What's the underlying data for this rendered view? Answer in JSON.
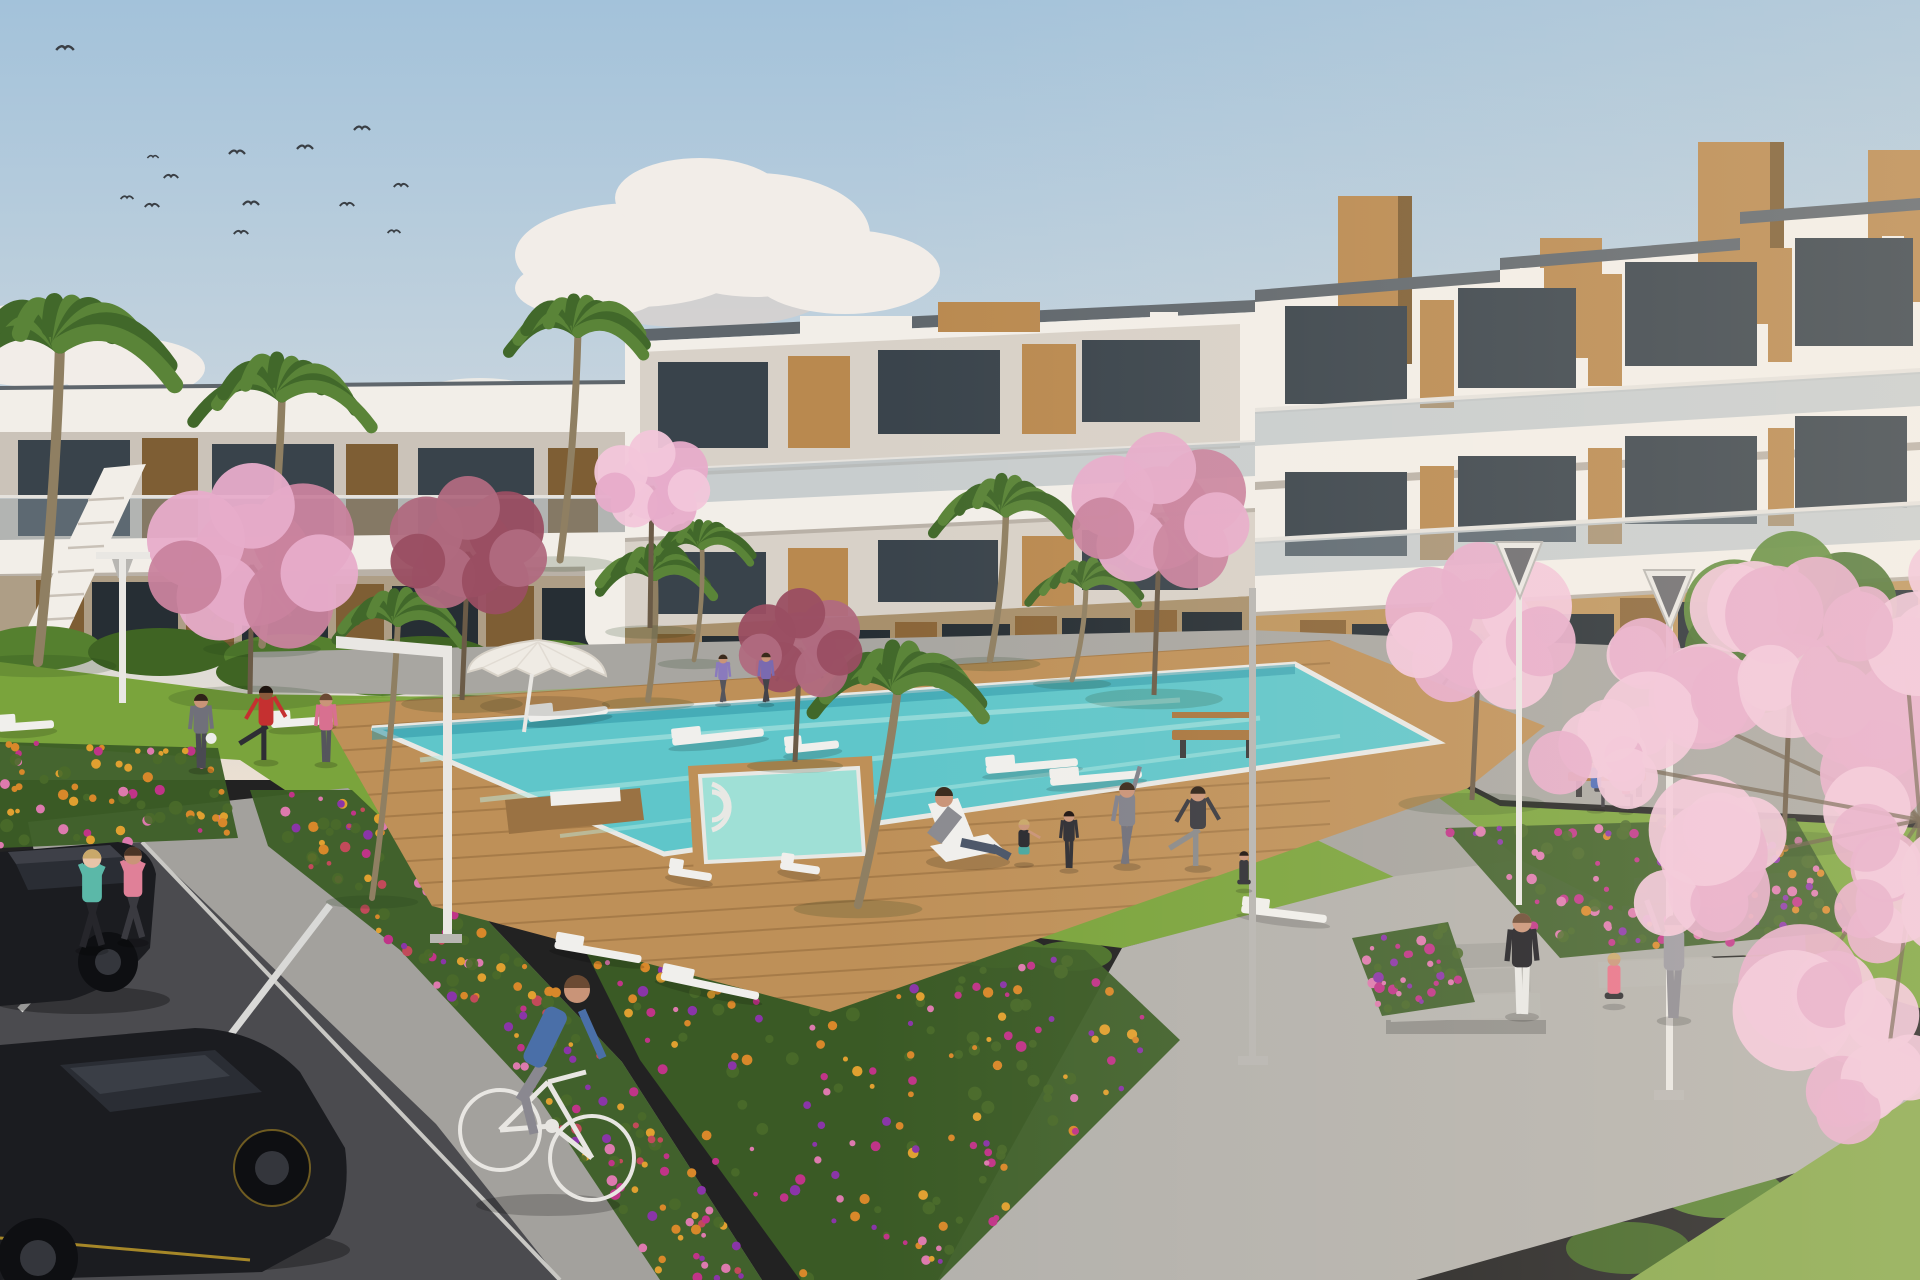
{
  "meta": {
    "domain": "natural-image",
    "description": "Sunny 3D architectural rendering of a modern white apartment complex with wooden accent panels around a landscaped courtyard: a turquoise swimming pool on a wooden deck, lawns where residents exercise and relax, colourful flower beds, palm and cherry-blossom trees, joggers and a cyclist on grey paths, black cars parked on a road in the lower left, and a flock of birds in a soft blue sky."
  },
  "palette": {
    "sky_top": "#A3C2DA",
    "sky_mid": "#C8D5DE",
    "sky_horizon": "#EADFD2",
    "cloud": "#F2EDE8",
    "cloud_shadow": "#DCD2CC",
    "bird": "#3A3F45",
    "building_white": "#F2EEE8",
    "building_white_dim": "#E6E0D8",
    "band_bg": "#D8D1C8",
    "band_bg2": "#CBC3B9",
    "slab_shadow": "#B9B1A7",
    "roof_trim": "#5F666C",
    "glass_dark": "#39434B",
    "glass_darker": "#2A333A",
    "glass_ground": "#262E34",
    "balustrade": "#8FA0AA",
    "rail": "#E5E2DD",
    "wood": "#B9894F",
    "wood_light": "#C89F63",
    "wood_dark": "#7E5E34",
    "wood_mid": "#8A6538",
    "tan_wall": "#BD945C",
    "tan_wall2": "#A8906C",
    "tan_lower": "#AE9E86",
    "gap_wall": "#9A7A4E",
    "hedge": "#3F6423",
    "hedge_light": "#55802F",
    "hedge_strip": "#4A7029",
    "grass": "#7AA43C",
    "grass_light": "#8CAF4C",
    "grass_dark": "#5E8A30",
    "corner_grass": "#86A84A",
    "walkway": "#A8A6A1",
    "path2": "#A5A39E",
    "plaza": "#B3B1AC",
    "sidewalk": "#A3A19D",
    "step1": "#B5B4AF",
    "step2": "#ACABA6",
    "step3": "#A3A29D",
    "step4": "#9A9994",
    "step_wall": "#8F8E8A",
    "road": "#4B4B4F",
    "curb": "#C9C8C4",
    "stripe": "#D9D9D7",
    "deck": "#BE9058",
    "deck_dark": "#9A7243",
    "deck_line": "#8A6336",
    "coping": "#E8E8E4",
    "water": "#5FC6CA",
    "water_far": "#2F98A8",
    "water_light": "#B9EAE4",
    "spa": "#9FE0D6",
    "lounger": "#F0EFEC",
    "umbrella": "#EFEBE4",
    "umbrella_shade": "#D8D2C8",
    "lamp": "#E9E7E3",
    "lamp_dark": "#6A6A6E",
    "pole_gray": "#B8B6B2",
    "bench_wood": "#A8763F",
    "bench_leg": "#3A3A3A",
    "car_body": "#1B1C20",
    "car_glass": "#2A2D34",
    "car_glass_hi": "#4A5058",
    "car_roof": "#3E4048",
    "wheel": "#0E0F12",
    "rim": "#34363C",
    "accent_yellow": "#C9A22A",
    "bike": "#E8E6E2",
    "trunk": "#8F7F62",
    "trunk_dark": "#6B5B47",
    "palm_green": "#5A8438",
    "palm_dark": "#41682A",
    "blossom_pink": "#E7ACCA",
    "blossom_light": "#F2C6DA",
    "blossom_dark": "#C9839E",
    "maroon": "#9A4E62",
    "maroon2": "#B06A80",
    "green_tree": "#5E8A3A",
    "green_tree_dark": "#4A7230",
    "flower_orange": "#D8882A",
    "flower_gold": "#E0A030",
    "flower_pink": "#DD7AAE",
    "flower_magenta": "#C03488",
    "flower_purple": "#8A35A8",
    "flower_red": "#C24A5A",
    "leaf_dark": "#3C5E26",
    "leaf_mid": "#4A6A2A",
    "skin": "#C99478",
    "sun_tint": "#FFEED8"
  },
  "scene": {
    "birds": [
      [
        65,
        50,
        1.1
      ],
      [
        237,
        154,
        1.0
      ],
      [
        305,
        149,
        1.0
      ],
      [
        362,
        130,
        1.0
      ],
      [
        171,
        178,
        0.9
      ],
      [
        127,
        199,
        0.8
      ],
      [
        152,
        207,
        0.9
      ],
      [
        251,
        205,
        1.0
      ],
      [
        347,
        206,
        0.9
      ],
      [
        401,
        187,
        0.9
      ],
      [
        241,
        234,
        0.9
      ],
      [
        394,
        233,
        0.8
      ],
      [
        153,
        158,
        0.7
      ]
    ],
    "hedges": [
      [
        40,
        648,
        62,
        22,
        "hedge_light"
      ],
      [
        160,
        652,
        72,
        24,
        "hedge"
      ],
      [
        290,
        656,
        66,
        22,
        "hedge_light"
      ],
      [
        425,
        660,
        70,
        24,
        "hedge"
      ],
      [
        550,
        662,
        62,
        22,
        "hedge_light"
      ],
      [
        672,
        676,
        58,
        24,
        "hedge"
      ],
      [
        790,
        672,
        64,
        24,
        "hedge_light"
      ],
      [
        908,
        668,
        64,
        24,
        "hedge"
      ],
      [
        1026,
        664,
        62,
        24,
        "hedge_light"
      ],
      [
        1144,
        660,
        58,
        22,
        "hedge"
      ],
      [
        1275,
        668,
        62,
        28,
        "hedge_light"
      ],
      [
        1390,
        676,
        72,
        30,
        "hedge"
      ],
      [
        1515,
        684,
        72,
        30,
        "hedge_light"
      ],
      [
        1648,
        694,
        78,
        32,
        "hedge"
      ],
      [
        1788,
        704,
        78,
        32,
        "hedge_light"
      ],
      [
        1900,
        712,
        62,
        30,
        "hedge"
      ],
      [
        272,
        672,
        56,
        20,
        "hedge"
      ],
      [
        382,
        676,
        56,
        20,
        "hedge_light"
      ],
      [
        492,
        680,
        54,
        20,
        "hedge"
      ],
      [
        600,
        928,
        46,
        16,
        "hedge_strip"
      ],
      [
        700,
        936,
        50,
        17,
        "hedge_strip"
      ],
      [
        800,
        942,
        50,
        17,
        "hedge_strip"
      ],
      [
        900,
        948,
        50,
        17,
        "hedge_strip"
      ],
      [
        1000,
        952,
        48,
        16,
        "hedge_strip"
      ],
      [
        1072,
        956,
        40,
        15,
        "hedge_strip"
      ],
      [
        1628,
        1248,
        62,
        26,
        "hedge"
      ],
      [
        1722,
        1192,
        62,
        26,
        "hedge_light"
      ],
      [
        1814,
        1136,
        60,
        26,
        "hedge"
      ],
      [
        1896,
        1088,
        56,
        24,
        "hedge_light"
      ]
    ],
    "flower_beds": [
      {
        "name": "left-walkside",
        "points": [
          [
            250,
            790
          ],
          [
            352,
            790
          ],
          [
            470,
            902
          ],
          [
            622,
            1062
          ],
          [
            762,
            1280
          ],
          [
            660,
            1280
          ],
          [
            540,
            1100
          ],
          [
            400,
            950
          ],
          [
            268,
            846
          ]
        ],
        "n": 180,
        "colors": [
          "flower_orange",
          "flower_gold",
          "flower_magenta",
          "flower_pink",
          "flower_red",
          "flower_purple"
        ]
      },
      {
        "name": "bottom-center",
        "points": [
          [
            570,
            920
          ],
          [
            1085,
            950
          ],
          [
            1180,
            1040
          ],
          [
            940,
            1280
          ],
          [
            800,
            1280
          ],
          [
            640,
            1060
          ]
        ],
        "n": 200,
        "colors": [
          "flower_magenta",
          "flower_purple",
          "flower_orange",
          "flower_pink",
          "flower_gold"
        ]
      },
      {
        "name": "right-lawn",
        "points": [
          [
            1445,
            828
          ],
          [
            1795,
            818
          ],
          [
            1858,
            930
          ],
          [
            1560,
            958
          ]
        ],
        "n": 110,
        "colors": [
          "flower_magenta",
          "flower_orange",
          "flower_pink",
          "flower_purple"
        ]
      },
      {
        "name": "right-small",
        "points": [
          [
            1352,
            938
          ],
          [
            1448,
            922
          ],
          [
            1475,
            1002
          ],
          [
            1382,
            1016
          ]
        ],
        "n": 36,
        "colors": [
          "flower_purple",
          "flower_magenta",
          "flower_pink"
        ]
      },
      {
        "name": "left-small",
        "points": [
          [
            0,
            742
          ],
          [
            218,
            748
          ],
          [
            238,
            838
          ],
          [
            0,
            848
          ]
        ],
        "n": 70,
        "colors": [
          "flower_pink",
          "flower_orange",
          "flower_magenta",
          "flower_gold"
        ]
      }
    ],
    "palms": [
      [
        60,
        345,
        112,
        38,
        662
      ],
      [
        282,
        396,
        84,
        262,
        645
      ],
      [
        578,
        332,
        78,
        560,
        560
      ],
      [
        655,
        576,
        66,
        648,
        700
      ],
      [
        702,
        546,
        52,
        694,
        660
      ],
      [
        898,
        688,
        92,
        858,
        905
      ],
      [
        1006,
        512,
        72,
        990,
        660
      ],
      [
        1086,
        586,
        56,
        1072,
        680
      ],
      [
        398,
        622,
        66,
        372,
        898
      ]
    ],
    "blossoms": [
      {
        "x": 252,
        "y": 565,
        "r": 102,
        "c1": "blossom_pink",
        "c2": "blossom_dark",
        "tx": 250,
        "ty": 694
      },
      {
        "x": 468,
        "y": 552,
        "r": 76,
        "c1": "maroon2",
        "c2": "maroon",
        "tx": 462,
        "ty": 700
      },
      {
        "x": 652,
        "y": 486,
        "r": 56,
        "c1": "blossom_light",
        "c2": "blossom_pink",
        "tx": 650,
        "ty": 628
      },
      {
        "x": 800,
        "y": 648,
        "r": 60,
        "c1": "maroon",
        "c2": "maroon2",
        "tx": 795,
        "ty": 762
      },
      {
        "x": 1160,
        "y": 518,
        "r": 86,
        "c1": "blossom_pink",
        "c2": "blossom_dark",
        "tx": 1154,
        "ty": 695
      },
      {
        "x": 1480,
        "y": 634,
        "r": 92,
        "c1": "blossom_pink",
        "c2": "blossom_light",
        "tx": 1472,
        "ty": 800
      },
      {
        "x": 1792,
        "y": 636,
        "r": 105,
        "c1": "green_tree",
        "c2": "green_tree_dark",
        "tx": 1784,
        "ty": 840,
        "specks": "blossom_pink"
      }
    ],
    "fg_blossoms": [
      [
        1660,
        700,
        95
      ],
      [
        1780,
        636,
        115
      ],
      [
        1862,
        762,
        135
      ],
      [
        1706,
        864,
        105
      ],
      [
        1826,
        962,
        115
      ],
      [
        1902,
        618,
        95
      ],
      [
        1592,
        760,
        65
      ],
      [
        1884,
        1086,
        80
      ],
      [
        1918,
        880,
        100
      ]
    ],
    "loungers": [
      [
        568,
        714,
        80,
        -6
      ],
      [
        718,
        737,
        92,
        -6
      ],
      [
        812,
        747,
        54,
        -6
      ],
      [
        1032,
        766,
        92,
        -5
      ],
      [
        1096,
        778,
        92,
        -5
      ],
      [
        302,
        722,
        62,
        -4
      ],
      [
        26,
        726,
        56,
        -4
      ],
      [
        598,
        952,
        88,
        10
      ],
      [
        710,
        986,
        100,
        12
      ],
      [
        1284,
        914,
        86,
        7
      ],
      [
        690,
        874,
        44,
        9
      ],
      [
        800,
        868,
        40,
        8
      ]
    ],
    "people": [
      {
        "label": "jogger-teal",
        "pose": "jog",
        "x": 92,
        "y": 948,
        "h": 104,
        "shirt": "#5BB8A8",
        "pants": "#26262B",
        "skin": "#E8C4A8",
        "hair": "#C9A86A"
      },
      {
        "label": "jogger-pink",
        "pose": "jog",
        "x": 133,
        "y": 940,
        "h": 98,
        "shirt": "#E08098",
        "pants": "#3A3A40",
        "hair": "#4A3426"
      },
      {
        "label": "man-with-ball",
        "pose": "stand",
        "x": 201,
        "y": 768,
        "h": 78,
        "shirt": "#70707A",
        "pants": "#4A4A52",
        "prop": "ball",
        "hair": "#2E2218"
      },
      {
        "label": "man-red-stretch",
        "pose": "stretchleg",
        "x": 266,
        "y": 760,
        "h": 78,
        "shirt": "#C53030",
        "pants": "#2E2E34",
        "skin": "#8A5A3C",
        "hair": "#1E1410"
      },
      {
        "label": "woman-pink",
        "pose": "stand",
        "x": 326,
        "y": 762,
        "h": 72,
        "shirt": "#D87090",
        "pants": "#55555C",
        "hair": "#6B4A33"
      },
      {
        "label": "woman-squatting",
        "pose": "squat",
        "x": 1024,
        "y": 862,
        "h": 62,
        "shirt": "#2A2A30",
        "pants": "#4AA8A0",
        "hair": "#C9A86A"
      },
      {
        "label": "kid-hoodie",
        "pose": "stand",
        "x": 1069,
        "y": 868,
        "h": 60,
        "shirt": "#2E2E34",
        "pants": "#2E2E34",
        "hair": "#1E1410"
      },
      {
        "label": "man-stretching-up",
        "pose": "armup",
        "x": 1127,
        "y": 864,
        "h": 86,
        "shirt": "#80808A",
        "pants": "#70707A",
        "hair": "#3A2A1C"
      },
      {
        "label": "man-quad-stretch",
        "pose": "stretchleg",
        "x": 1198,
        "y": 866,
        "h": 84,
        "shirt": "#3A3A40",
        "pants": "#8A8A8A",
        "hair": "#2E2218"
      },
      {
        "label": "person-meditating",
        "pose": "meditate",
        "x": 1244,
        "y": 888,
        "h": 52,
        "shirt": "#2E2E34",
        "pants": "#2E2E34",
        "hair": "#1E1410"
      },
      {
        "label": "woman-black-top",
        "pose": "stand",
        "x": 1522,
        "y": 1014,
        "h": 106,
        "shirt": "#1E1E24",
        "pants": "#E8E8E6",
        "hair": "#6B4A33"
      },
      {
        "label": "woman-pink-sitting",
        "pose": "meditate",
        "x": 1614,
        "y": 1004,
        "h": 72,
        "shirt": "#E87088",
        "pants": "#2A2A2E",
        "hair": "#C9A86A"
      },
      {
        "label": "woman-arms-raised",
        "pose": "bothup",
        "x": 1674,
        "y": 1018,
        "h": 108,
        "shirt": "#9A98A0",
        "pants": "#8A8890",
        "hair": "#3A2A1C"
      },
      {
        "label": "bench-man-blue",
        "pose": "sit",
        "x": 1596,
        "y": 808,
        "h": 58,
        "shirt": "#4A6AB8",
        "pants": "#3A3A40",
        "hair": "#2E2218"
      },
      {
        "label": "bench-child-red",
        "pose": "sit",
        "x": 1626,
        "y": 810,
        "h": 46,
        "shirt": "#C04858",
        "pants": "#4A4A50",
        "hair": "#2E2218"
      },
      {
        "label": "walker-lavender",
        "pose": "walk",
        "x": 766,
        "y": 702,
        "h": 52,
        "shirt": "#7A6AB0",
        "pants": "#44444A",
        "hair": "#3A2A1C"
      },
      {
        "label": "walker-violet",
        "pose": "walk",
        "x": 723,
        "y": 702,
        "h": 50,
        "shirt": "#8A7ABD",
        "pants": "#55555C",
        "hair": "#3A2A1C"
      }
    ],
    "cyclist": {
      "label": "cyclist-blue-sweater",
      "sweater": "#4A6FA8",
      "pants": "#8A8890",
      "hair": "#6B4A33"
    }
  }
}
